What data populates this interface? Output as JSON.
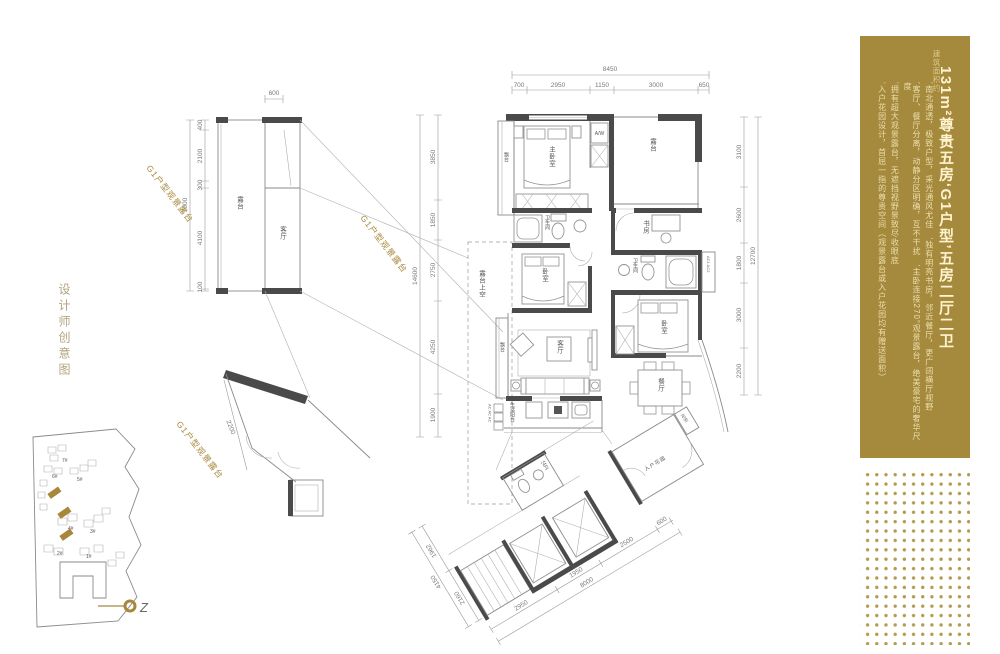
{
  "page": {
    "side_caption": "设计师创意图"
  },
  "panel": {
    "bg_color": "#a5893c",
    "area_note": "建筑面积约",
    "title": "131m²尊贵五房‘G1户型’五房二厅二卫",
    "bullets": [
      "’南北通透，极致户型，采光通风尤佳　’独有明亮书房，邻近餐厅，更广阔横厅视野",
      "’客厅、餐厅分离，动静分区明确，互不干扰　’主卧连接270°观景露台，绝美豪宅的奢华尺度",
      "’拥有超大观景露台，无遮挡视野景致尽收眼底",
      "’入户花园设计，首屈一指的尊贵空间（观景露台或入户花园均有赠送面积）"
    ]
  },
  "plan": {
    "callout": "G1户型观景露台",
    "rooms": {
      "terrace_detail": "露台",
      "living_detail": "客厅",
      "bay_top": "飘台",
      "master_bedroom": "主卧室",
      "appliance": "A/W",
      "terrace_top": "露台",
      "bath_1": "卫生间",
      "study": "书房",
      "bath_2": "卫生间",
      "ac_closet": "AC1 AC2",
      "bedroom_2": "卧室",
      "bedroom_3": "卧室",
      "living": "客厅",
      "bay_living": "飘台",
      "dining": "餐厅",
      "service_balcony": "生活阳台",
      "ac_units": "AC AC AC",
      "terrace_void": "露台上空",
      "entry_garden": "入户花园",
      "planter": "花池",
      "lobby_wc": "公卫"
    },
    "dims": {
      "top_total": "8450",
      "top": [
        "700",
        "2950",
        "1150",
        "3000",
        "650"
      ],
      "left_total": "14600",
      "left": [
        "3850",
        "1850",
        "2750",
        "4250",
        "1900"
      ],
      "right_total": "12700",
      "right": [
        "3100",
        "2600",
        "1800",
        "3000",
        "2200"
      ],
      "detail_top": "600",
      "detail_total": "7000",
      "detail": [
        "400",
        "2100",
        "300",
        "4100",
        "100"
      ],
      "wing_left_total": "4150",
      "wing_left": [
        "1962",
        "2160"
      ],
      "wing_bottom_total": "8000",
      "wing_bottom": [
        "2950",
        "1950",
        "2500",
        "600"
      ],
      "terrace": "2200"
    }
  },
  "site": {
    "buildings": [
      "1#",
      "2#",
      "3#",
      "4#",
      "5#",
      "6#",
      "7#"
    ],
    "compass": "Z"
  }
}
